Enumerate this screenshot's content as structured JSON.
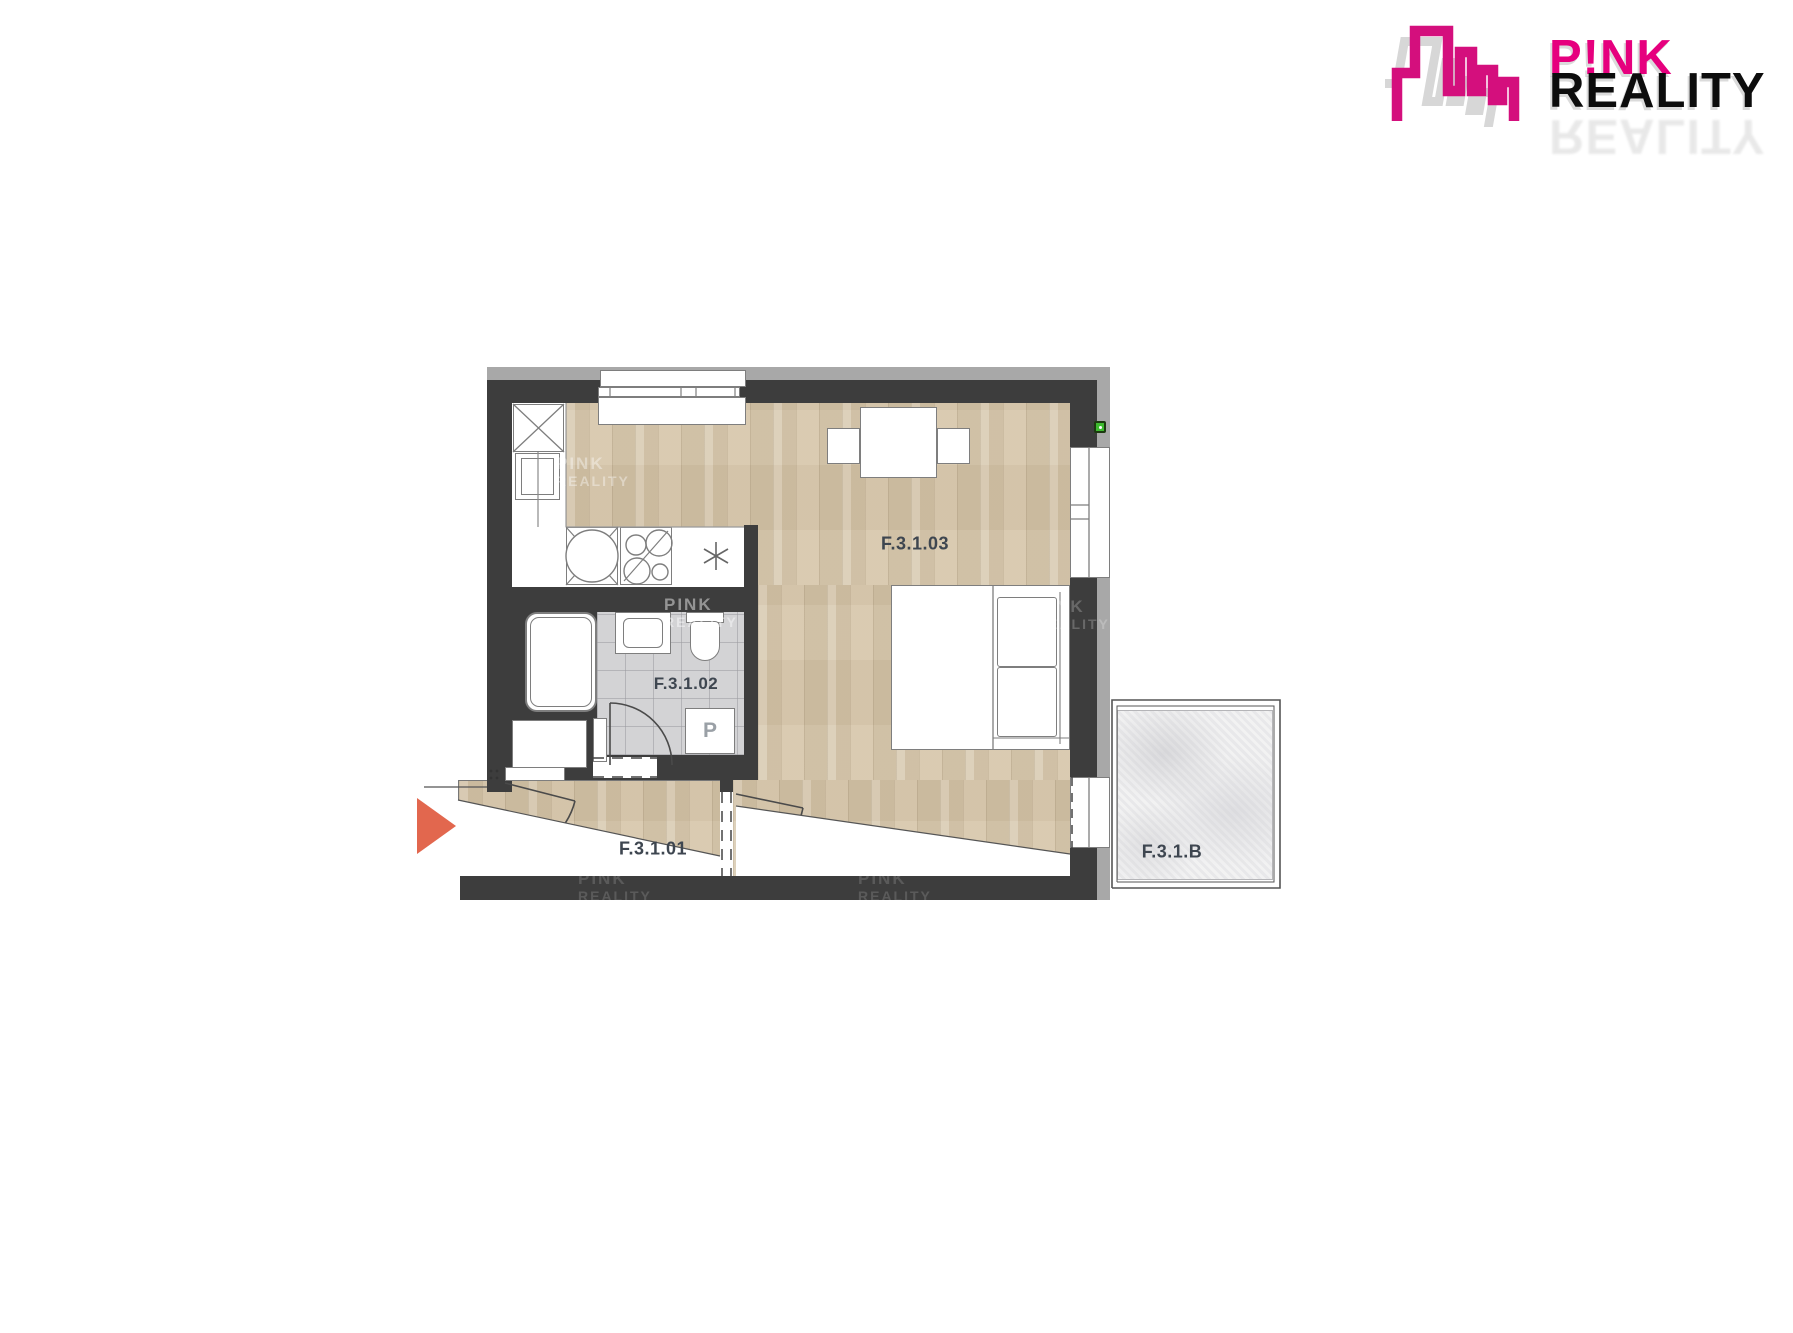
{
  "logo": {
    "line1": "P!NK",
    "line2": "REALITY",
    "icon": "city-skyline-icon",
    "color_primary": "#E6007E",
    "color_text": "#0D0D0D"
  },
  "floor_plan": {
    "rooms": [
      {
        "id": "F.3.1.01"
      },
      {
        "id": "F.3.1.02"
      },
      {
        "id": "F.3.1.03"
      },
      {
        "id": "F.3.1.B"
      }
    ],
    "washing_machine_label": "P",
    "watermark": {
      "line1": "PINK",
      "line2": "REALITY"
    },
    "colors": {
      "wall": "#3D3D3D",
      "outer_wall_band": "#A8A8A8",
      "wood_floor": "#D5C5AA",
      "bathroom_tile": "#D3D3D5",
      "balcony_floor": "#EDEDEE",
      "entrance_arrow": "#E2674E",
      "utility_marker": "#3DBB2E"
    }
  }
}
